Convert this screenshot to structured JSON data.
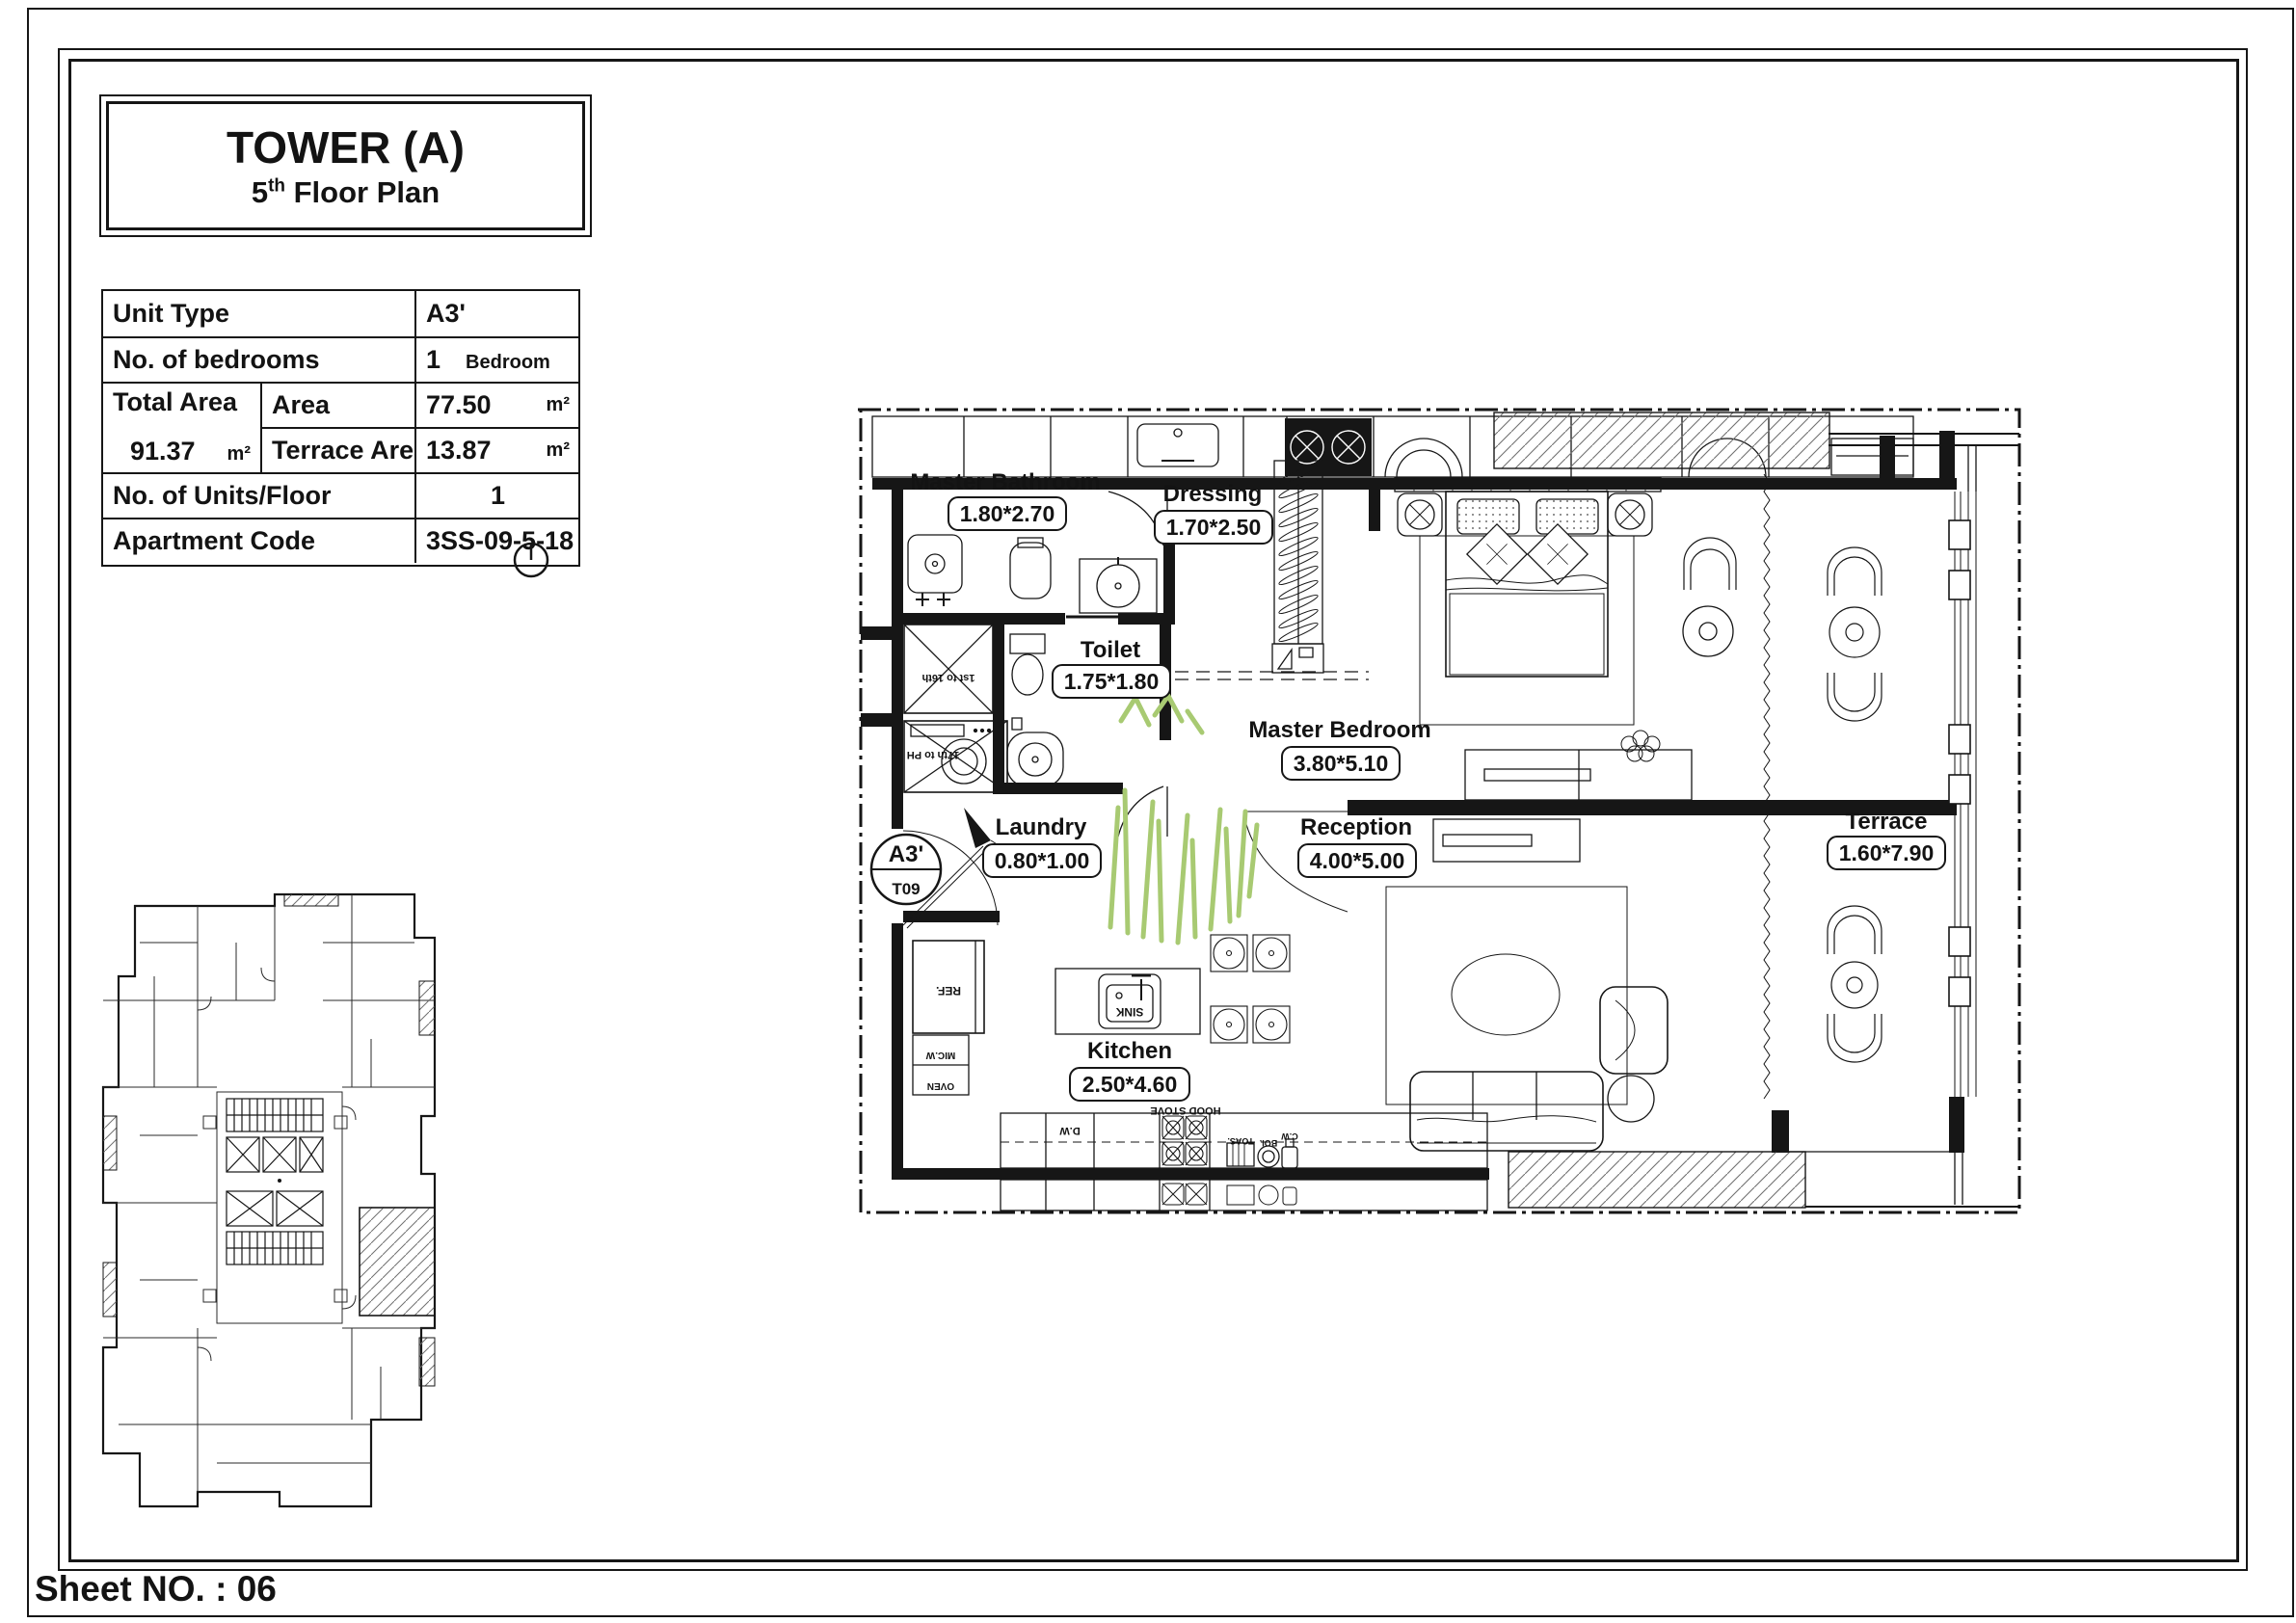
{
  "title_block": {
    "title": "TOWER (A)",
    "floor_prefix": "5",
    "floor_sup": "th",
    "floor_rest": " Floor Plan"
  },
  "info_table": {
    "unit_type_label": "Unit Type",
    "unit_type_value": "A3'",
    "bedrooms_label": "No. of bedrooms",
    "bedrooms_number": "1",
    "bedrooms_unit": "Bedroom",
    "total_area_label": "Total Area",
    "total_area_value": "91.37",
    "total_area_unit": "m²",
    "area_label": "Area",
    "area_value": "77.50",
    "area_unit": "m²",
    "terrace_area_label": "Terrace Area",
    "terrace_area_value": "13.87",
    "terrace_area_unit": "m²",
    "units_per_floor_label": "No. of Units/Floor",
    "units_per_floor_value": "1",
    "apartment_code_label": "Apartment Code",
    "apartment_code_value": "3SS-09-5-18"
  },
  "badge": {
    "unit": "A3'",
    "tower": "T09"
  },
  "rooms": [
    {
      "name": "Master Bathroom",
      "dim": "1.80*2.70"
    },
    {
      "name": "Dressing",
      "dim": "1.70*2.50"
    },
    {
      "name": "Toilet",
      "dim": "1.75*1.80"
    },
    {
      "name": "Master Bedroom",
      "dim": "3.80*5.10"
    },
    {
      "name": "Laundry",
      "dim": "0.80*1.00"
    },
    {
      "name": "Reception",
      "dim": "4.00*5.00"
    },
    {
      "name": "Kitchen",
      "dim": "2.50*4.60"
    },
    {
      "name": "Terrace",
      "dim": "1.60*7.90"
    }
  ],
  "annotations": {
    "sink": "SINK",
    "hood_stove": "HOOD STOVE",
    "ref": "REF.",
    "mic": "MIC.W",
    "oven": "OVEN",
    "dw": "D.W",
    "toast": "TOAS.",
    "boiler": "BOI.",
    "cw": "C.W",
    "shaft_upper": "1st to 16th",
    "shaft_lower": "17th to PH"
  },
  "sheet": {
    "label": "Sheet NO. : 06"
  },
  "colors": {
    "ink": "#161616",
    "plant": "#a8ca72",
    "hatch": "#707070"
  }
}
